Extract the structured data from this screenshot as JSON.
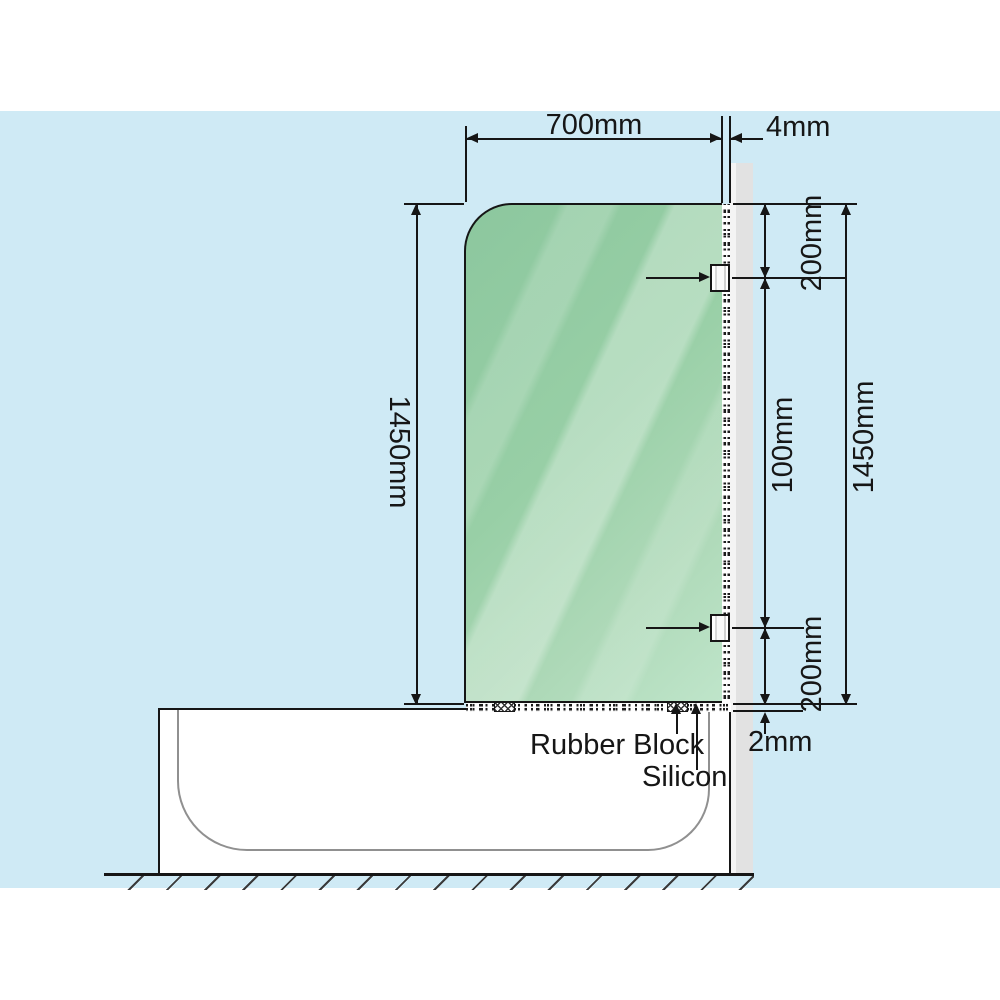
{
  "diagram": {
    "subject": "Bath shower screen installation side diagram",
    "dims": {
      "width_top": "700mm",
      "glass_gap": "4mm",
      "top_offset": "200mm",
      "mid_offset": "100mm",
      "height_left": "1450mm",
      "height_right": "1450mm",
      "bottom_offset": "200mm",
      "base_gap": "2mm"
    },
    "callouts": {
      "rubber_block": "Rubber Block",
      "silicon": "Silicon"
    },
    "colors": {
      "canvas": "#ffffff",
      "background_panel": "#cfeaf5",
      "glass_green": "#98cfa6",
      "glass_highlight": "#bfe5ca",
      "wall_grey": "#e2e2e2",
      "tub_white": "#ffffff",
      "tub_inner_line": "#909090",
      "line": "#161616"
    }
  }
}
